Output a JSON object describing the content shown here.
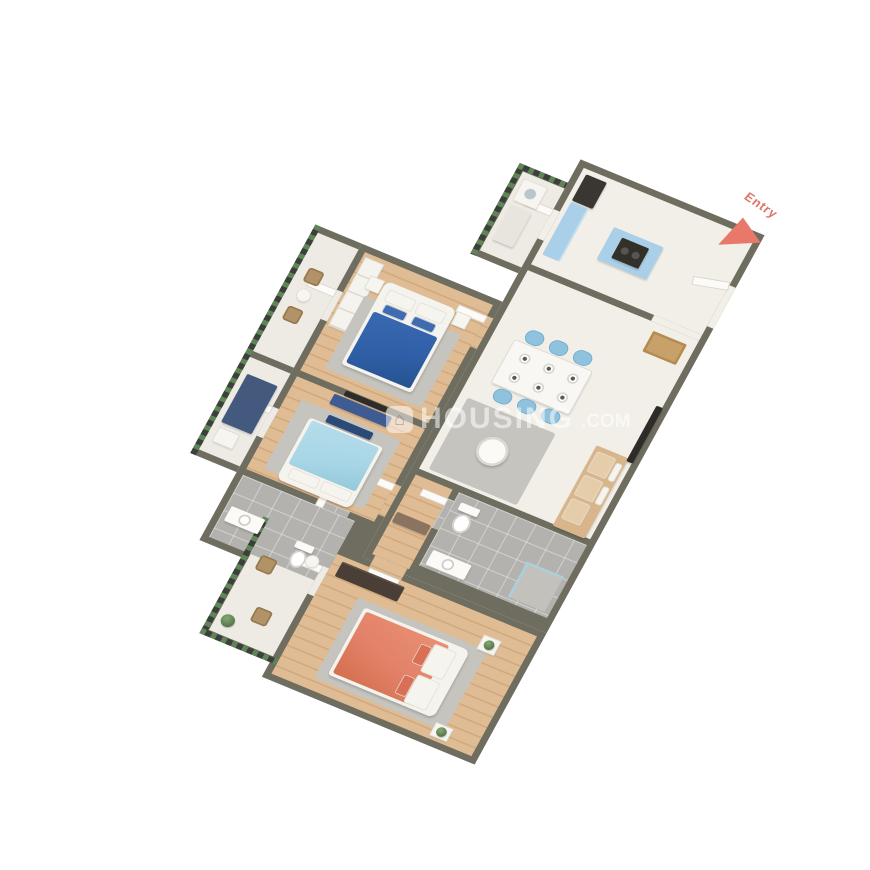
{
  "scene": {
    "type": "3d-isometric-floor-plan",
    "description": "3BHK apartment 3D render on white background, viewed from above at an angle",
    "rooms": [
      "kitchen",
      "entry-foyer",
      "dining-area",
      "living-room",
      "common-bathroom",
      "hallway",
      "bedroom-blue",
      "bedroom-cyan",
      "attached-bathroom",
      "master-bedroom",
      "balcony-top",
      "balcony-mid",
      "utility-balcony",
      "master-balcony"
    ]
  },
  "labels": {
    "entry": "Entry"
  },
  "watermark": {
    "logo_glyph": "⌂",
    "brand": "HOUSING",
    "suffix": ".COM"
  },
  "colors": {
    "background": "#ffffff",
    "wall": "#6e6d5f",
    "floor_cream": "#f2efe8",
    "floor_wood": "#d9b48c",
    "floor_tile": "#b3b2ae",
    "railing_green": "#5f8557",
    "railing_dark": "#3b403b",
    "entry_accent": "#e8796a",
    "bed_blue": "#2e5ea6",
    "bed_cyan": "#a8d6e6",
    "bed_coral": "#e28168",
    "sofa_tan": "#d8b58b",
    "kitchen_cabinet_blue": "#a9d0e8",
    "dining_chair_blue": "#8fc2dc",
    "console_navy": "#3e5c92",
    "watermark_white": "rgba(255,255,255,0.55)"
  }
}
